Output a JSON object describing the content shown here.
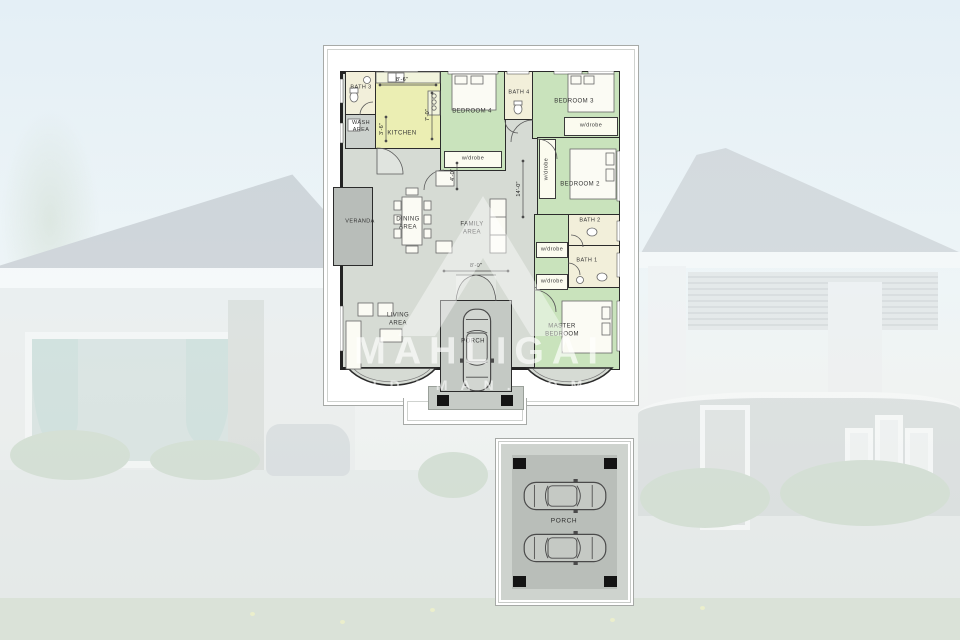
{
  "watermark": {
    "title": "MAHLIGAI",
    "subtitle": "IDAMAN.COM"
  },
  "plan": {
    "rooms": {
      "bath3": "BATH 3",
      "wash": "WASH\nAREA",
      "kitchen": "KITCHEN",
      "bedroom4": "BEDROOM 4",
      "bath4": "BATH 4",
      "bedroom3": "BEDROOM 3",
      "bedroom2": "BEDROOM 2",
      "wardrobe": "w/drobe",
      "veranda": "VERANDA",
      "dining": "DINING\nAREA",
      "family": "FAMILY\nAREA",
      "bath2": "BATH 2",
      "bath1": "BATH 1",
      "living": "LIVING\nAREA",
      "porch": "PORCH",
      "master": "MASTER\nBEDROOM"
    },
    "dimensions": {
      "kitchen_width": "8'-6\"",
      "kitchen_height": "7'-0\"",
      "wash_width": "3'-6\"",
      "hall_door": "4'-0\"",
      "hallway_length": "14'-0\"",
      "entry_width": "8'-0\""
    }
  },
  "carport": {
    "label": "PORCH"
  },
  "palette": {
    "kitchen_fill": "#EBEEB3",
    "bedroom_fill": "#C9E3BC",
    "bath_fill": "#F2EFDA",
    "floor_fill": "#D6DBD4",
    "wall_color": "#232323"
  }
}
